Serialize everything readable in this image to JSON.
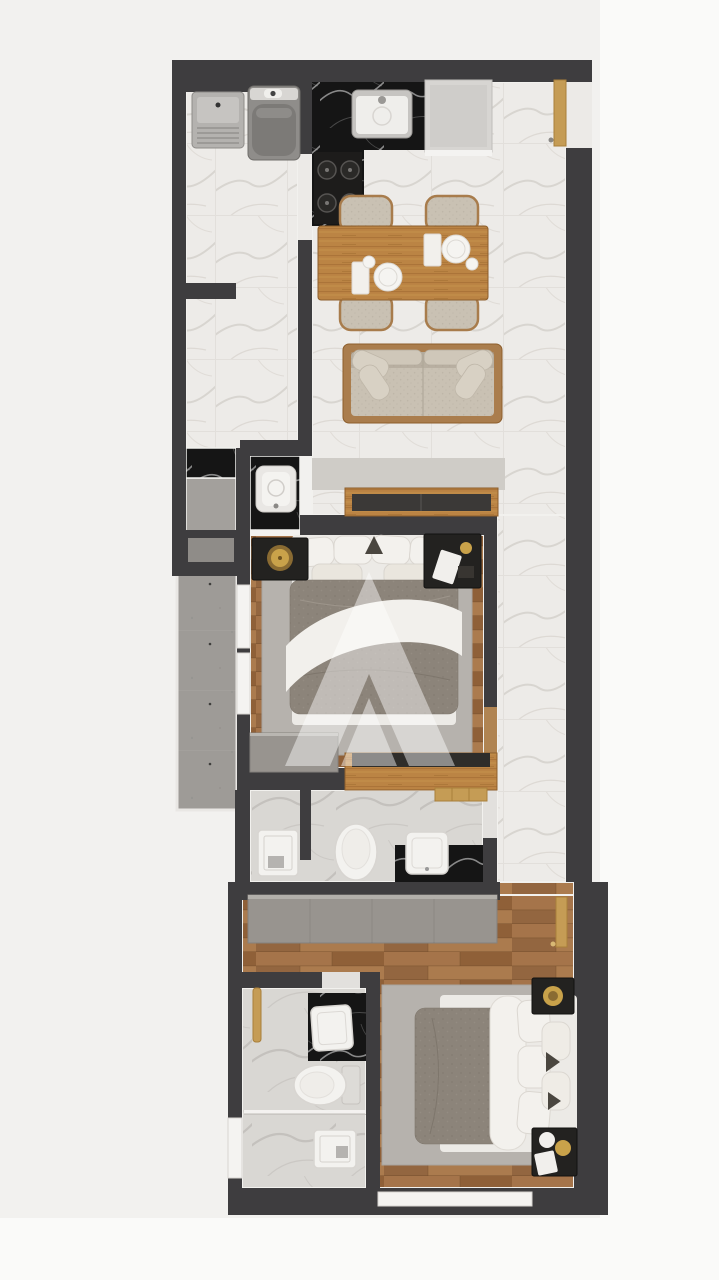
{
  "meta": {
    "content_type": "3d-floor-plan-render",
    "view": "top-down",
    "canvas": {
      "width": 719,
      "height": 1280
    },
    "visible_text": "none"
  },
  "watermark": {
    "name": "stylized-letter-A-logo",
    "color": "#ffffff",
    "opacity": 0.45
  },
  "palette": {
    "background": "#f2f1ef",
    "background_light": "#fafaf9",
    "wall": "#3e3d3f",
    "skirting": "#f2f1ee",
    "marble_floor": "#edebe8",
    "marble_gray": "#d9d7d3",
    "black_marble": "#151515",
    "wood_floor": "#9c6c42",
    "wood_furniture": "#b98342",
    "wood_trim": "#8d5e2c",
    "fabric": "#c9c1b3",
    "rug": "#b6b2ad",
    "duvet": "#8c847a",
    "bedding_white": "#f3f1ed",
    "cabinet_gray": "#98948f",
    "concrete": "#9e9b97",
    "gold": "#c9a24a",
    "dark_furniture": "#232220",
    "fixture_white": "#f3f2ef",
    "appliance_gray": "#8f8d8a"
  },
  "rooms": [
    {
      "name": "service-laundry",
      "floor": "white-marble",
      "items": [
        "laundry-tub",
        "washing-machine"
      ]
    },
    {
      "name": "kitchen",
      "floor": "white-marble",
      "items": [
        "black-marble-l-counter",
        "double-sink",
        "cooktop-4-burners",
        "refrigerator"
      ]
    },
    {
      "name": "dining-area",
      "floor": "white-marble",
      "items": [
        "wooden-dining-table",
        "chair-x4",
        "place-setting-x2"
      ]
    },
    {
      "name": "living-room",
      "floor": "white-marble",
      "items": [
        "sofa-with-pillows",
        "tv-console"
      ]
    },
    {
      "name": "entry",
      "items": [
        "entry-door"
      ]
    },
    {
      "name": "washbasin-nook",
      "floor": "black-marble",
      "items": [
        "square-basin"
      ]
    },
    {
      "name": "closet-nook",
      "items": [
        "black-marble-shelf"
      ]
    },
    {
      "name": "balcony-shaft",
      "floor": "concrete",
      "items": []
    },
    {
      "name": "bedroom-1",
      "floor": "wood-planks",
      "items": [
        "double-bed",
        "nightstand-with-lamp",
        "nightstand-with-decor",
        "gray-rug",
        "gray-dresser",
        "low-wood-cabinet",
        "window-x2"
      ]
    },
    {
      "name": "hallway",
      "floor": "white-marble",
      "items": []
    },
    {
      "name": "bathroom-1",
      "floor": "gray-marble",
      "items": [
        "shower-tray",
        "toilet",
        "black-marble-vanity-sink",
        "wood-towel-shelf"
      ]
    },
    {
      "name": "bedroom-2",
      "floor": "wood-planks",
      "items": [
        "gray-wardrobe",
        "double-bed",
        "nightstand-x2",
        "gray-rug",
        "door-leaf",
        "window"
      ]
    },
    {
      "name": "ensuite-bathroom",
      "floor": "gray-marble",
      "items": [
        "black-marble-vanity-sink",
        "gold-towel-bar",
        "toilet",
        "glass-partition",
        "shower-tray",
        "window"
      ]
    }
  ]
}
